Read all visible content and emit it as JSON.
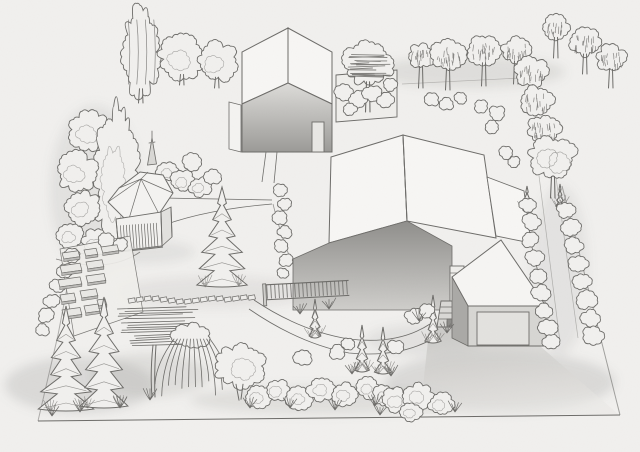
{
  "scene": {
    "description": "Hand-drawn pencil perspective sketch of a landscaped residential plot: two modern gable-roof houses, hexagonal gazebo with slatted railing, vegetable garden with raised beds, stepping-stone path, curved walkway, driveway with garage and outdoor steps, perimeter rows of round-canopy trees, spruces, junipers, a weeping willow and shrub borders",
    "style": {
      "paper_fill": "#f1f0ee",
      "line": "#6d6c69",
      "shade": "#8f8e8b",
      "roof_fill": "#f7f6f4"
    },
    "items": [
      {
        "t": "poplar",
        "l": "back",
        "x": 141,
        "y": 52,
        "rx": 17,
        "ry": 46,
        "g": 103
      },
      {
        "t": "cloud",
        "l": "back",
        "x": 182,
        "y": 57,
        "r": 23,
        "g": 85
      },
      {
        "t": "cloud",
        "l": "back",
        "x": 217,
        "y": 62,
        "r": 20,
        "g": 88
      },
      {
        "t": "cloud",
        "l": "back",
        "x": 90,
        "y": 132,
        "r": 21
      },
      {
        "t": "oval",
        "l": "back",
        "x": 117,
        "y": 178,
        "rx": 21,
        "ry": 72
      },
      {
        "t": "cloud",
        "l": "back",
        "x": 77,
        "y": 172,
        "r": 20
      },
      {
        "t": "cloud",
        "l": "back",
        "x": 83,
        "y": 208,
        "r": 17
      },
      {
        "t": "cloud",
        "l": "back",
        "x": 70,
        "y": 236,
        "r": 13
      },
      {
        "t": "cloud",
        "l": "back",
        "x": 96,
        "y": 243,
        "r": 14
      },
      {
        "t": "spire",
        "l": "back",
        "x": 152,
        "y": 138
      },
      {
        "t": "bush",
        "l": "back",
        "x": 168,
        "y": 172,
        "r": 11
      },
      {
        "t": "bush",
        "l": "back",
        "x": 183,
        "y": 181,
        "r": 12
      },
      {
        "t": "bush",
        "l": "back",
        "x": 200,
        "y": 187,
        "r": 11
      },
      {
        "t": "bush",
        "l": "back",
        "x": 212,
        "y": 177,
        "r": 9
      },
      {
        "t": "bush",
        "l": "back",
        "x": 192,
        "y": 162,
        "r": 9
      },
      {
        "t": "hatch",
        "l": "back",
        "x": 368,
        "y": 63,
        "r": 25,
        "g": 112
      },
      {
        "t": "bush",
        "l": "back",
        "x": 344,
        "y": 92,
        "r": 9
      },
      {
        "t": "bush",
        "l": "back",
        "x": 358,
        "y": 99,
        "r": 9
      },
      {
        "t": "bush",
        "l": "back",
        "x": 372,
        "y": 93,
        "r": 9
      },
      {
        "t": "bush",
        "l": "back",
        "x": 386,
        "y": 100,
        "r": 8
      },
      {
        "t": "bush",
        "l": "back",
        "x": 390,
        "y": 85,
        "r": 7
      },
      {
        "t": "bush",
        "l": "back",
        "x": 350,
        "y": 109,
        "r": 7
      },
      {
        "t": "round",
        "l": "back",
        "x": 421,
        "y": 56,
        "r": 13,
        "g": 88
      },
      {
        "t": "round",
        "l": "back",
        "x": 448,
        "y": 55,
        "r": 17,
        "g": 90
      },
      {
        "t": "round",
        "l": "back",
        "x": 484,
        "y": 50,
        "r": 16,
        "g": 86
      },
      {
        "t": "round",
        "l": "back",
        "x": 516,
        "y": 50,
        "r": 14,
        "g": 84
      },
      {
        "t": "round",
        "l": "back",
        "x": 556,
        "y": 27,
        "r": 13,
        "g": 58
      },
      {
        "t": "round",
        "l": "back",
        "x": 585,
        "y": 42,
        "r": 15,
        "g": 74
      },
      {
        "t": "round",
        "l": "back",
        "x": 611,
        "y": 58,
        "r": 14,
        "g": 88
      },
      {
        "t": "round",
        "l": "back",
        "x": 531,
        "y": 72,
        "r": 16
      },
      {
        "t": "round",
        "l": "back",
        "x": 537,
        "y": 101,
        "r": 16
      },
      {
        "t": "round",
        "l": "back",
        "x": 544,
        "y": 130,
        "r": 16
      },
      {
        "t": "fluffy",
        "l": "back",
        "x": 553,
        "y": 158,
        "r": 23,
        "g": 198
      },
      {
        "t": "bush",
        "l": "back",
        "x": 432,
        "y": 100,
        "r": 7
      },
      {
        "t": "bush",
        "l": "back",
        "x": 447,
        "y": 104,
        "r": 7
      },
      {
        "t": "bush",
        "l": "back",
        "x": 461,
        "y": 98,
        "r": 6
      },
      {
        "t": "bush",
        "l": "back",
        "x": 481,
        "y": 106,
        "r": 7
      },
      {
        "t": "bush",
        "l": "back",
        "x": 497,
        "y": 113,
        "r": 8
      },
      {
        "t": "bush",
        "l": "back",
        "x": 492,
        "y": 127,
        "r": 7
      },
      {
        "t": "bush",
        "l": "back",
        "x": 506,
        "y": 153,
        "r": 7
      },
      {
        "t": "bush",
        "l": "back",
        "x": 514,
        "y": 162,
        "r": 6
      },
      {
        "t": "bush",
        "l": "mid",
        "x": 281,
        "y": 190,
        "r": 7
      },
      {
        "t": "bush",
        "l": "mid",
        "x": 285,
        "y": 204,
        "r": 7
      },
      {
        "t": "bush",
        "l": "mid",
        "x": 280,
        "y": 218,
        "r": 7
      },
      {
        "t": "bush",
        "l": "mid",
        "x": 285,
        "y": 232,
        "r": 7
      },
      {
        "t": "bush",
        "l": "mid",
        "x": 281,
        "y": 246,
        "r": 7
      },
      {
        "t": "bush",
        "l": "mid",
        "x": 286,
        "y": 260,
        "r": 7
      },
      {
        "t": "bush",
        "l": "mid",
        "x": 283,
        "y": 273,
        "r": 6
      },
      {
        "t": "spruce",
        "l": "mid",
        "x": 222,
        "y": 187,
        "h": 98,
        "w": 56
      },
      {
        "t": "ball",
        "l": "mid",
        "x": 72,
        "y": 256,
        "r": 8
      },
      {
        "t": "ball",
        "l": "mid",
        "x": 65,
        "y": 271,
        "r": 8
      },
      {
        "t": "ball",
        "l": "mid",
        "x": 58,
        "y": 286,
        "r": 8
      },
      {
        "t": "ball",
        "l": "mid",
        "x": 52,
        "y": 301,
        "r": 8
      },
      {
        "t": "ball",
        "l": "mid",
        "x": 46,
        "y": 316,
        "r": 8
      },
      {
        "t": "ball",
        "l": "mid",
        "x": 42,
        "y": 330,
        "r": 7
      },
      {
        "t": "bush",
        "l": "mid",
        "x": 106,
        "y": 240,
        "r": 8
      },
      {
        "t": "bush",
        "l": "mid",
        "x": 120,
        "y": 244,
        "r": 7
      },
      {
        "t": "beds",
        "l": "mid",
        "list": [
          [
            62,
            253,
            16,
            6
          ],
          [
            84,
            250,
            12,
            6
          ],
          [
            101,
            247,
            16,
            6
          ],
          [
            60,
            266,
            20,
            7
          ],
          [
            86,
            262,
            16,
            7
          ],
          [
            58,
            280,
            22,
            7
          ],
          [
            86,
            276,
            18,
            7
          ],
          [
            60,
            295,
            14,
            7
          ],
          [
            80,
            291,
            16,
            7
          ],
          [
            62,
            310,
            18,
            7
          ],
          [
            84,
            306,
            14,
            7
          ],
          [
            97,
            300,
            8,
            6
          ]
        ]
      },
      {
        "t": "stones",
        "l": "mid",
        "list": [
          [
            128,
            299
          ],
          [
            136,
            298
          ],
          [
            144,
            297
          ],
          [
            152,
            297
          ],
          [
            160,
            298
          ],
          [
            168,
            299
          ],
          [
            176,
            300
          ],
          [
            184,
            300
          ],
          [
            192,
            299
          ],
          [
            200,
            298
          ],
          [
            208,
            297
          ],
          [
            216,
            297
          ],
          [
            224,
            298
          ],
          [
            232,
            297
          ],
          [
            240,
            296
          ],
          [
            248,
            296
          ]
        ]
      },
      {
        "t": "juniper",
        "l": "mid",
        "x": 527,
        "y": 186,
        "h": 24,
        "w": 9
      },
      {
        "t": "juniper",
        "l": "mid",
        "x": 560,
        "y": 184,
        "h": 22,
        "w": 8
      },
      {
        "t": "bush",
        "l": "mid",
        "x": 528,
        "y": 205,
        "r": 8
      },
      {
        "t": "bush",
        "l": "mid",
        "x": 532,
        "y": 222,
        "r": 9
      },
      {
        "t": "bush",
        "l": "mid",
        "x": 530,
        "y": 240,
        "r": 8
      },
      {
        "t": "bush",
        "l": "mid",
        "x": 535,
        "y": 258,
        "r": 9
      },
      {
        "t": "bush",
        "l": "mid",
        "x": 538,
        "y": 276,
        "r": 8
      },
      {
        "t": "bush",
        "l": "mid",
        "x": 541,
        "y": 293,
        "r": 9
      },
      {
        "t": "bush",
        "l": "mid",
        "x": 544,
        "y": 311,
        "r": 8
      },
      {
        "t": "bush",
        "l": "mid",
        "x": 548,
        "y": 328,
        "r": 9
      },
      {
        "t": "bush",
        "l": "mid",
        "x": 551,
        "y": 342,
        "r": 8
      },
      {
        "t": "bush",
        "l": "mid",
        "x": 566,
        "y": 210,
        "r": 9
      },
      {
        "t": "bush",
        "l": "mid",
        "x": 570,
        "y": 228,
        "r": 10
      },
      {
        "t": "bush",
        "l": "mid",
        "x": 574,
        "y": 246,
        "r": 9
      },
      {
        "t": "bush",
        "l": "mid",
        "x": 578,
        "y": 264,
        "r": 10
      },
      {
        "t": "bush",
        "l": "mid",
        "x": 582,
        "y": 282,
        "r": 9
      },
      {
        "t": "bush",
        "l": "mid",
        "x": 586,
        "y": 300,
        "r": 10
      },
      {
        "t": "bush",
        "l": "mid",
        "x": 590,
        "y": 318,
        "r": 9
      },
      {
        "t": "bush",
        "l": "mid",
        "x": 593,
        "y": 335,
        "r": 10
      },
      {
        "t": "spruce",
        "l": "front",
        "x": 66,
        "y": 306,
        "h": 103,
        "w": 52
      },
      {
        "t": "spruce",
        "l": "front",
        "x": 104,
        "y": 297,
        "h": 109,
        "w": 54
      },
      {
        "t": "flatpine",
        "l": "front",
        "x": 155,
        "y": 303
      },
      {
        "t": "willow",
        "l": "front",
        "x": 192,
        "y": 336,
        "w": 60,
        "h": 62
      },
      {
        "t": "bushy",
        "l": "front",
        "x": 240,
        "y": 366,
        "r": 26
      },
      {
        "t": "juniper",
        "l": "front",
        "x": 315,
        "y": 299,
        "h": 37,
        "w": 13
      },
      {
        "t": "grass",
        "l": "front",
        "x": 300,
        "y": 314
      },
      {
        "t": "grass",
        "l": "front",
        "x": 329,
        "y": 309
      },
      {
        "t": "bush",
        "l": "front",
        "x": 303,
        "y": 357,
        "r": 9
      },
      {
        "t": "bush",
        "l": "front",
        "x": 337,
        "y": 352,
        "r": 8
      },
      {
        "t": "juniper",
        "l": "front",
        "x": 362,
        "y": 325,
        "h": 45,
        "w": 16
      },
      {
        "t": "juniper",
        "l": "front",
        "x": 383,
        "y": 327,
        "h": 45,
        "w": 16
      },
      {
        "t": "bush",
        "l": "front",
        "x": 348,
        "y": 344,
        "r": 7
      },
      {
        "t": "bush",
        "l": "front",
        "x": 396,
        "y": 347,
        "r": 8
      },
      {
        "t": "grass",
        "l": "front",
        "x": 352,
        "y": 374
      },
      {
        "t": "grass",
        "l": "front",
        "x": 391,
        "y": 376
      },
      {
        "t": "juniper",
        "l": "front",
        "x": 433,
        "y": 295,
        "h": 46,
        "w": 15
      },
      {
        "t": "bush",
        "l": "front",
        "x": 414,
        "y": 317,
        "r": 9
      },
      {
        "t": "bush",
        "l": "front",
        "x": 427,
        "y": 310,
        "r": 8
      },
      {
        "t": "grass",
        "l": "front",
        "x": 419,
        "y": 321
      },
      {
        "t": "grass",
        "l": "front",
        "x": 447,
        "y": 333
      },
      {
        "t": "bush",
        "l": "front",
        "x": 258,
        "y": 396,
        "r": 13
      },
      {
        "t": "bush",
        "l": "front",
        "x": 278,
        "y": 390,
        "r": 12
      },
      {
        "t": "bush",
        "l": "front",
        "x": 300,
        "y": 398,
        "r": 13
      },
      {
        "t": "bush",
        "l": "front",
        "x": 322,
        "y": 389,
        "r": 14
      },
      {
        "t": "bush",
        "l": "front",
        "x": 345,
        "y": 394,
        "r": 13
      },
      {
        "t": "bush",
        "l": "front",
        "x": 368,
        "y": 388,
        "r": 12
      },
      {
        "t": "bush",
        "l": "front",
        "x": 385,
        "y": 396,
        "r": 12
      },
      {
        "t": "grass",
        "l": "front",
        "x": 250,
        "y": 408
      },
      {
        "t": "grass",
        "l": "front",
        "x": 290,
        "y": 408
      },
      {
        "t": "grass",
        "l": "front",
        "x": 335,
        "y": 410
      },
      {
        "t": "grass",
        "l": "front",
        "x": 375,
        "y": 406
      },
      {
        "t": "bush",
        "l": "front",
        "x": 396,
        "y": 400,
        "r": 14
      },
      {
        "t": "bush",
        "l": "front",
        "x": 419,
        "y": 396,
        "r": 15
      },
      {
        "t": "bush",
        "l": "front",
        "x": 441,
        "y": 404,
        "r": 13
      },
      {
        "t": "bush",
        "l": "front",
        "x": 411,
        "y": 412,
        "r": 11
      },
      {
        "t": "grass",
        "l": "front",
        "x": 380,
        "y": 415
      },
      {
        "t": "grass",
        "l": "front",
        "x": 455,
        "y": 412
      },
      {
        "t": "grass",
        "l": "front",
        "x": 52,
        "y": 416
      },
      {
        "t": "grass",
        "l": "front",
        "x": 80,
        "y": 412
      },
      {
        "t": "grass",
        "l": "front",
        "x": 120,
        "y": 408
      },
      {
        "t": "grass",
        "l": "front",
        "x": 150,
        "y": 400
      }
    ]
  }
}
